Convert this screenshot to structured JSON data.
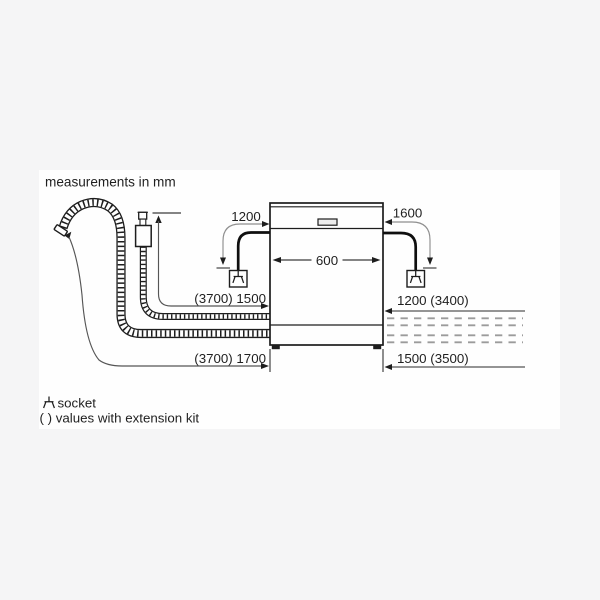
{
  "note_title": "measurements in mm",
  "dimensions": {
    "appliance_width": "600",
    "cable_left": "1200",
    "cable_right": "1600",
    "supply_hose": "(3700) 1500",
    "drain_hose": "(3700) 1700",
    "right_top": "1200 (3400)",
    "right_bottom": "1500 (3500)"
  },
  "legend": {
    "socket_label": "socket",
    "extension_note": "( ) values with extension kit"
  },
  "icons": {
    "socket": "din-socket-symbol"
  },
  "colors": {
    "background": "#f5f5f6",
    "canvas": "#fefefe",
    "ink": "#1d1d1d",
    "dimension_line": "#555555",
    "leader_line": "#8f8f8f",
    "dashed_line": "#9b9b9b"
  }
}
